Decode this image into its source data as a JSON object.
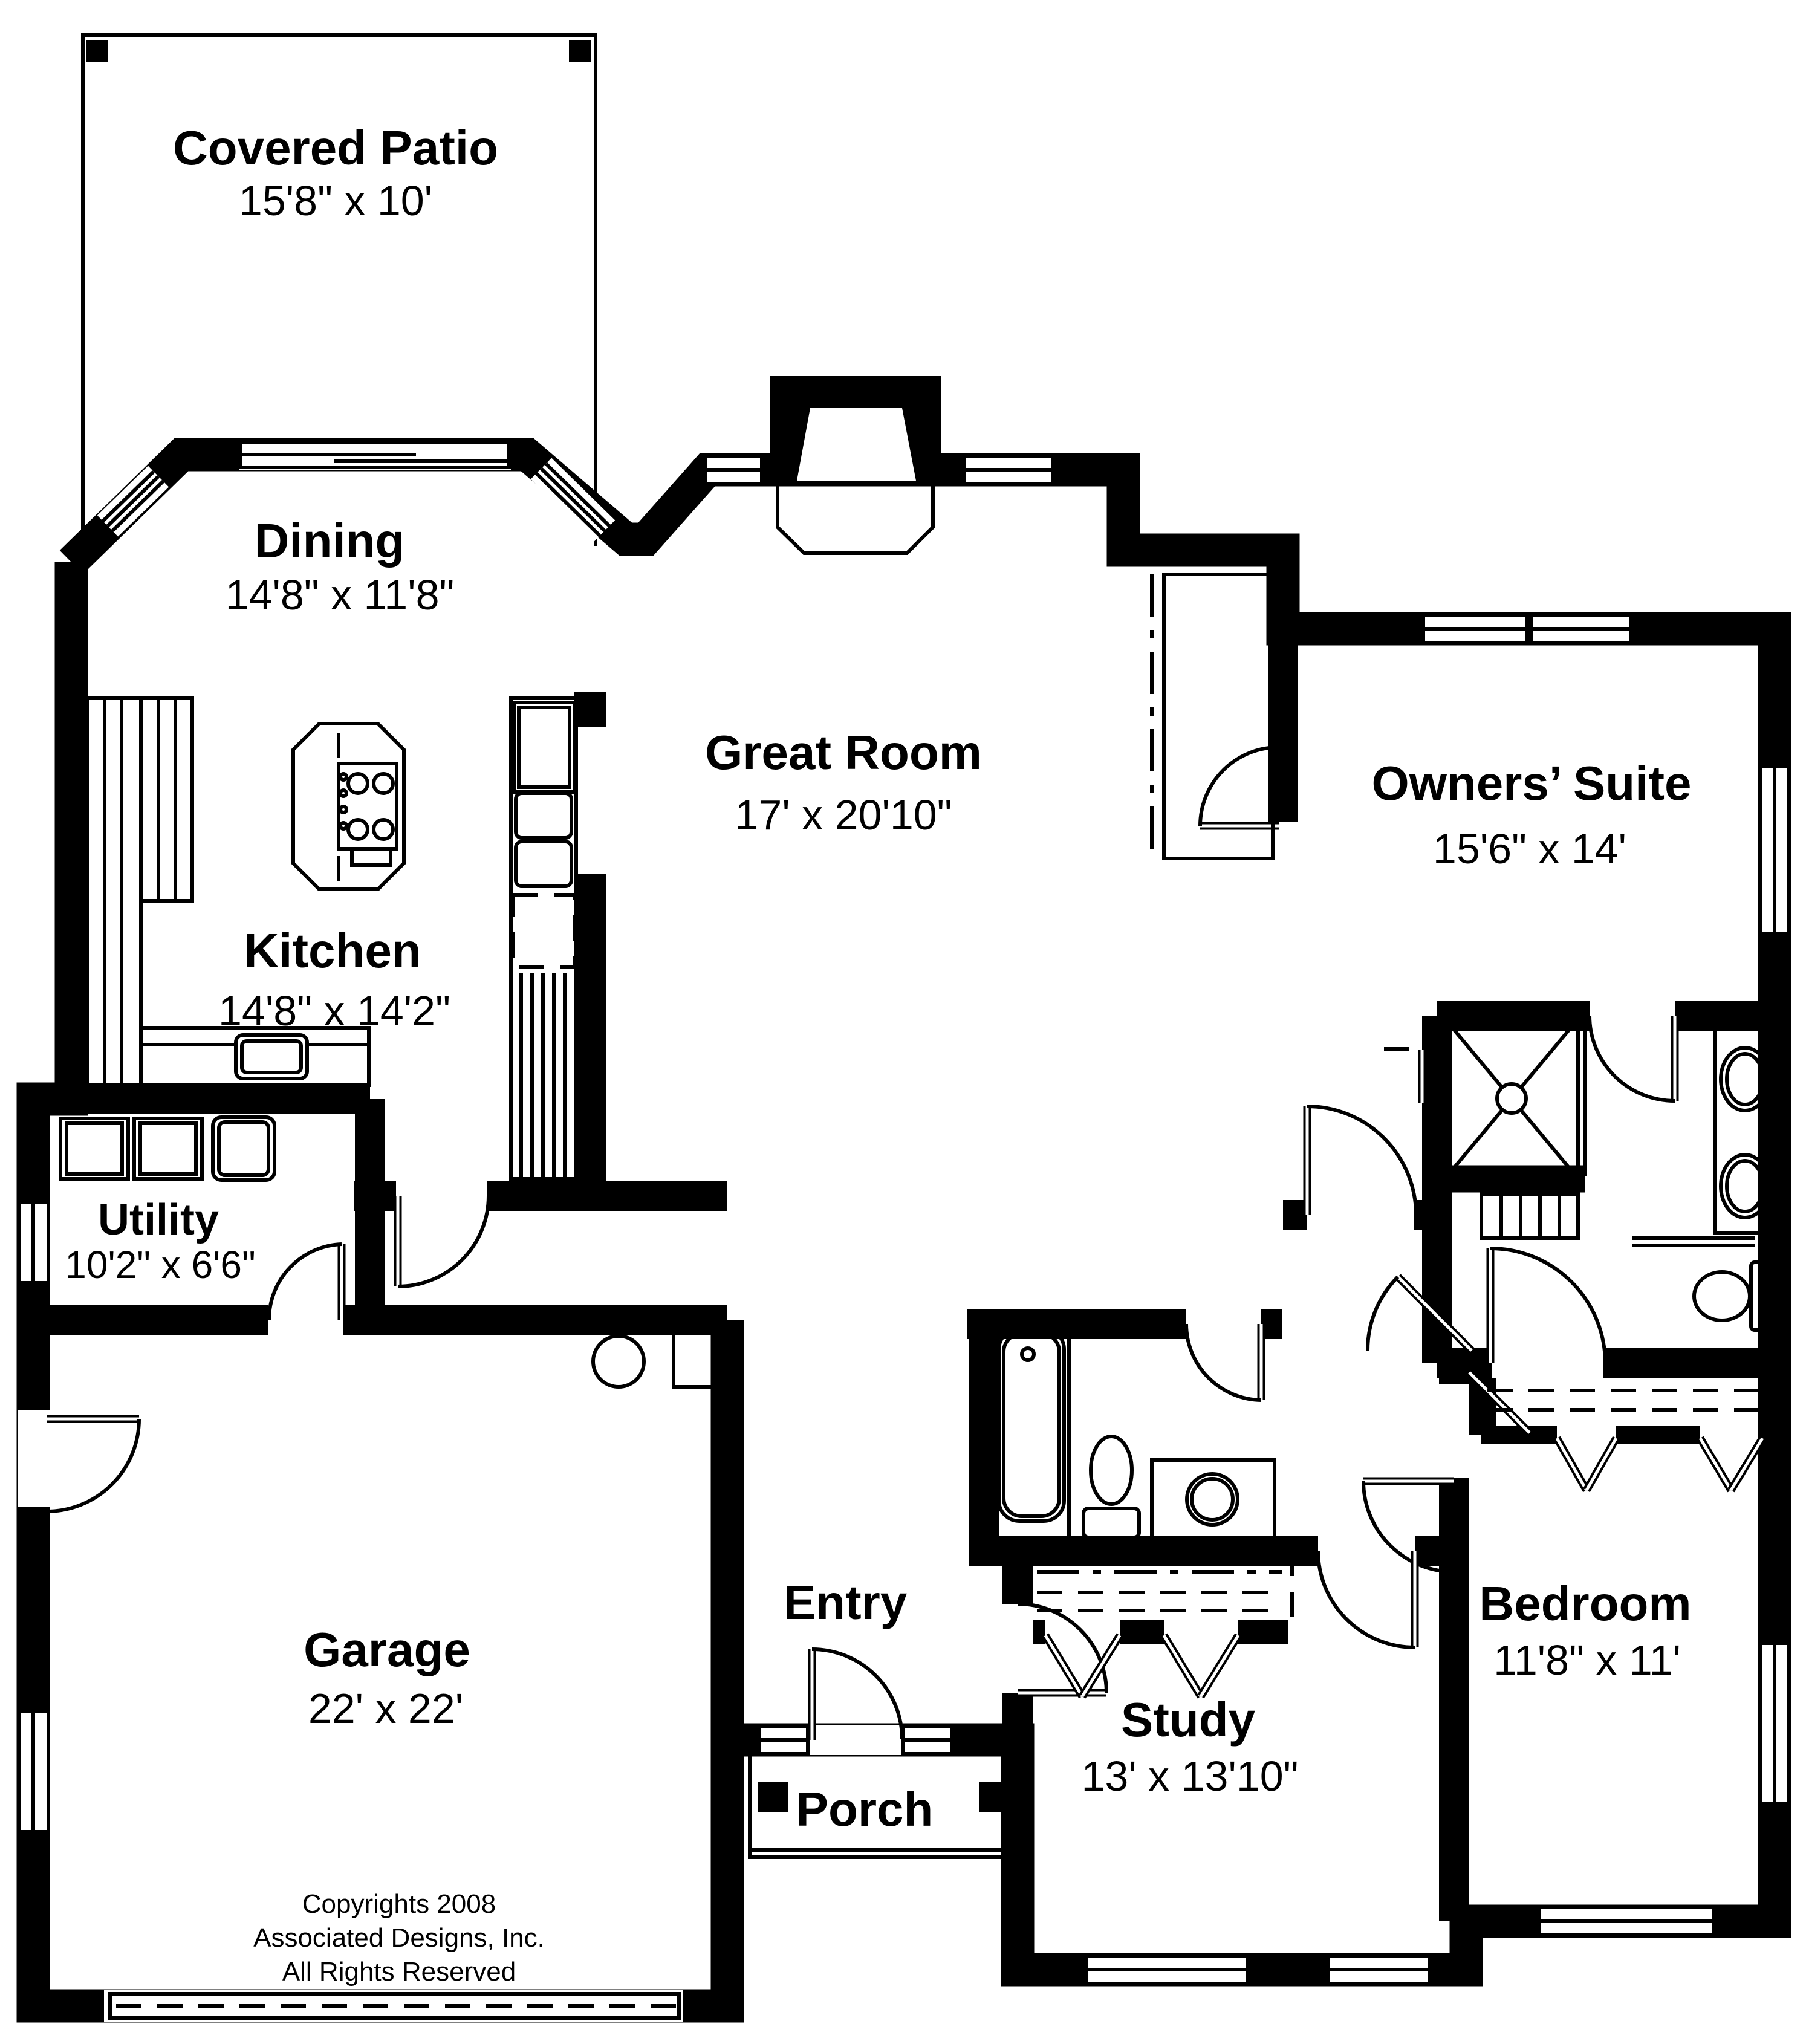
{
  "colors": {
    "ink": "#000000",
    "paper": "#ffffff"
  },
  "plan": {
    "rooms": [
      {
        "id": "covered-patio",
        "name": "Covered Patio",
        "dims": "15'8\" x 10'"
      },
      {
        "id": "dining",
        "name": "Dining",
        "dims": "14'8\" x 11'8\""
      },
      {
        "id": "great-room",
        "name": "Great Room",
        "dims": "17' x 20'10\""
      },
      {
        "id": "owners-suite",
        "name": "Owners’ Suite",
        "dims": "15'6\" x 14'"
      },
      {
        "id": "kitchen",
        "name": "Kitchen",
        "dims": "14'8\" x 14'2\""
      },
      {
        "id": "utility",
        "name": "Utility",
        "dims": "10'2\" x 6'6\""
      },
      {
        "id": "garage",
        "name": "Garage",
        "dims": "22' x 22'"
      },
      {
        "id": "entry",
        "name": "Entry",
        "dims": ""
      },
      {
        "id": "porch",
        "name": "Porch",
        "dims": ""
      },
      {
        "id": "study",
        "name": "Study",
        "dims": "13' x 13'10\""
      },
      {
        "id": "bedroom",
        "name": "Bedroom",
        "dims": "11'8\" x 11'"
      }
    ],
    "copyright": {
      "line1": "Copyrights 2008",
      "line2": "Associated Designs, Inc.",
      "line3": "All Rights Reserved"
    }
  }
}
